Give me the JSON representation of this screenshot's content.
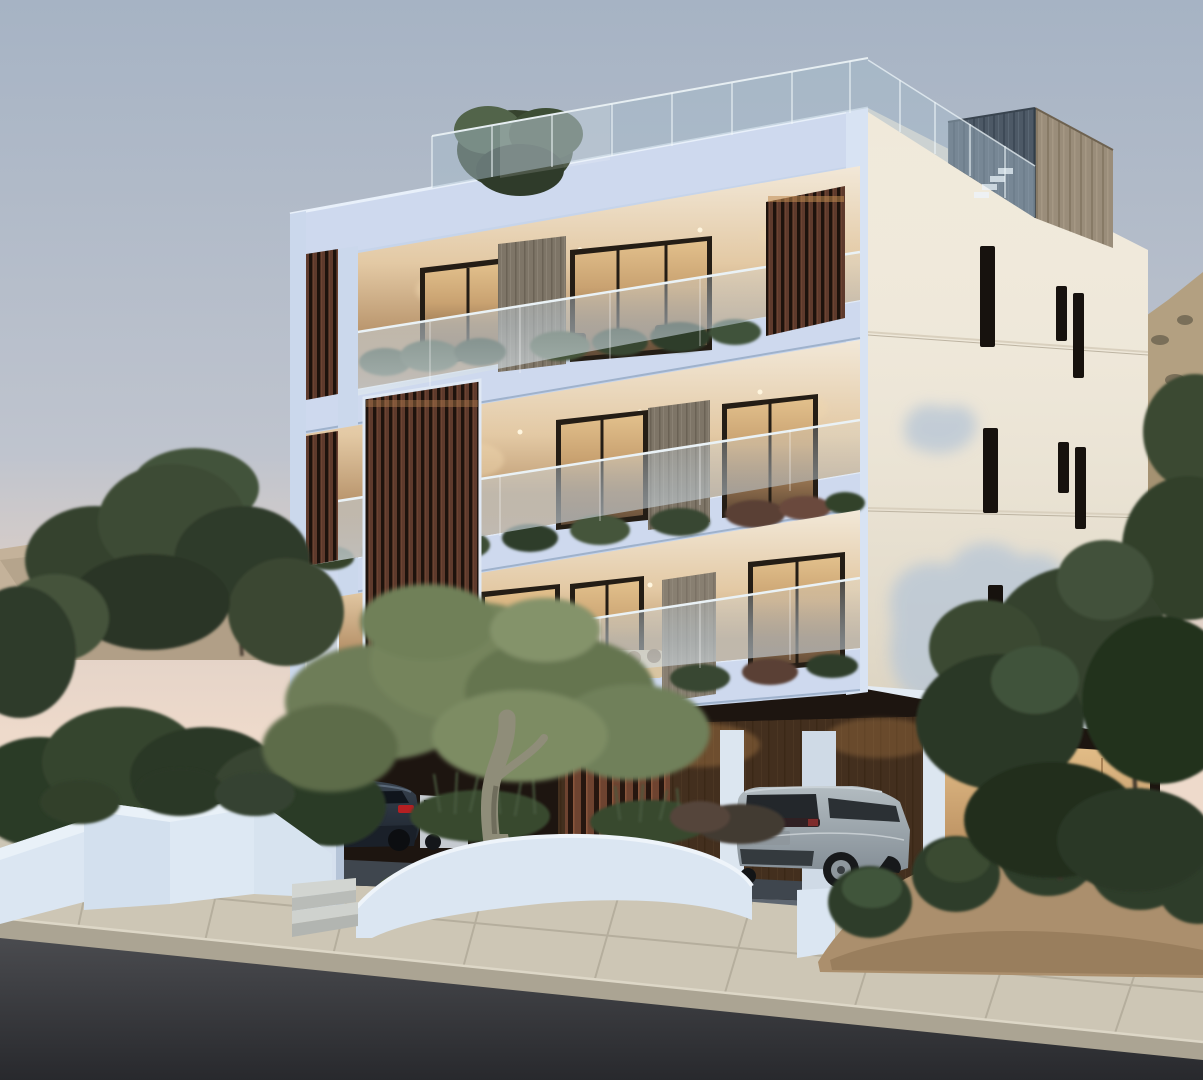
{
  "scene": {
    "type": "3d-architectural-rendering",
    "subject": "Modern three-storey apartment building at dusk with warm interior lighting",
    "building": {
      "storeys_visible": 3,
      "features": [
        "rooftop glass balustrade",
        "rooftop timber-clad volume",
        "vertical timber slat screens",
        "glass balcony railings with planters",
        "recessed warm-lit balconies",
        "cream side facade with narrow vertical slit windows",
        "ground-floor carport with timber cladding"
      ]
    },
    "vehicles": [
      {
        "kind": "dark sedan with red taillights",
        "location": "carport, left"
      },
      {
        "kind": "white car",
        "location": "partially hidden behind sedan"
      },
      {
        "kind": "silver SUV",
        "location": "driveway under building, right"
      }
    ],
    "environment": [
      "dusk sky, pink at horizon",
      "sandy excavated hill with two street lamps",
      "concrete block wall on hill",
      "olive tree in curved white planter",
      "stepped white planter walls with shrubs",
      "entry steps",
      "paved sidewalk and kerb",
      "asphalt road",
      "dense green trees left and right",
      "sand mound with round bushes"
    ]
  },
  "colors": {
    "sky_top": "#a6b3c4",
    "sky_horizon": "#eedacb",
    "hill_sand": "#c4b29a",
    "hillside_right": "#b3a081",
    "facade_front": "#c6d4ea",
    "facade_front_light": "#ced9ee",
    "facade_front_lighter": "#d8e3f3",
    "facade_side": "#f0e9da",
    "facade_shadow": "#b9c7d6",
    "fascia": "#e3ebf4",
    "slit_dark": "#17120e",
    "slat_wood": "#5e3a2c",
    "column_wood": "#7e7567",
    "roof_wood_front": "#4d5966",
    "roof_wood_side": "#9a8d7a",
    "glass_railing": "rgba(198,212,221,0.5)",
    "roof_glass": "rgba(165,185,200,0.48)",
    "interior_glow": "#d9b482",
    "carport_shadow": "#1d1510",
    "carport_lit": "#d9ae78",
    "tree_green": "#36432e",
    "olive_foliage": "#6e7d58",
    "plant_dark": "#2e3d2a",
    "planter_white": "#dbe6f2",
    "steps_gray": "#c9ccc9",
    "driveway": "#5f6771",
    "sidewalk": "#cdc6b5",
    "curb": "#aba493",
    "road": "#38393d",
    "car_sedan": "#232b37",
    "car_white": "#c6cbd1",
    "car_suv": "#9ca7ae",
    "car_glass": "#23272b",
    "taillight_red": "#b51f22",
    "lamp_pole": "#5f5f5c",
    "grass": "#46572f"
  }
}
